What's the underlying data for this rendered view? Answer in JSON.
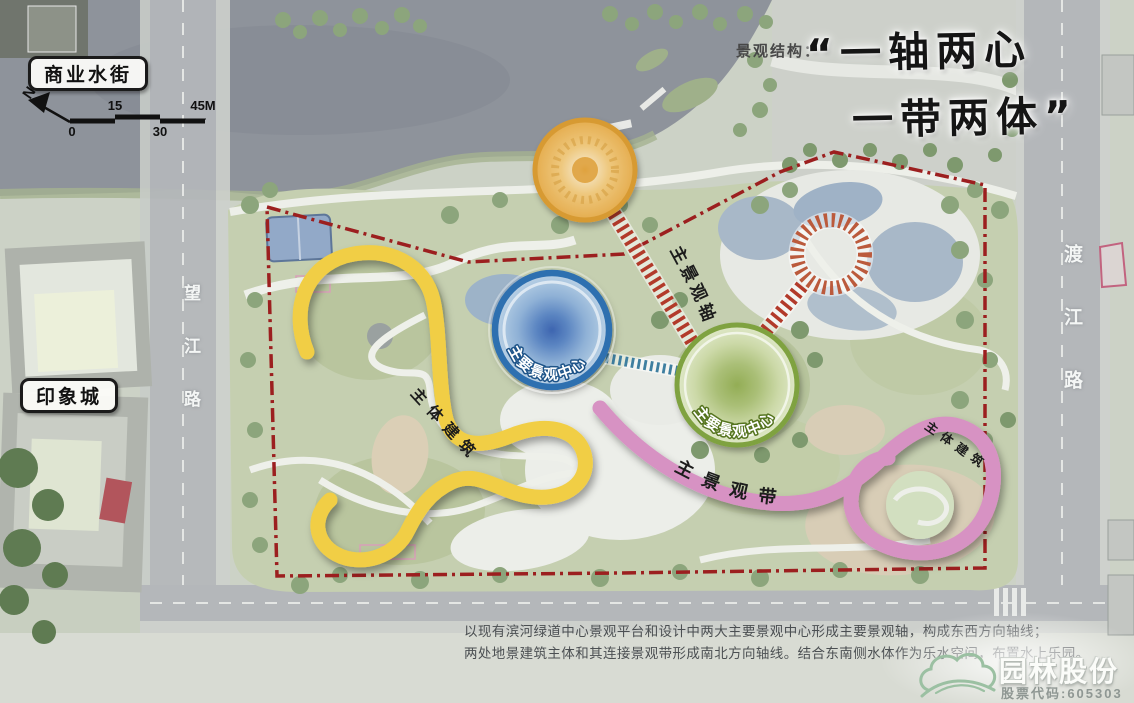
{
  "header": {
    "structure_label": "景观结构：",
    "quote_line1": "“一轴两心",
    "quote_line2": "一带两体”"
  },
  "compass": {
    "north": "N"
  },
  "scalebar": {
    "zero": "0",
    "fifteen": "15",
    "thirty": "30",
    "end": "45M"
  },
  "site_labels": {
    "commercial_street": "商业水街",
    "impression_city": "印象城",
    "wangjiang_road": "望江路",
    "dujiang_road": "渡江路"
  },
  "plan_annotations": {
    "main_axis": "主景观轴",
    "main_center_blue": "主要景观中心",
    "main_center_green": "主要景观中心",
    "main_belt": "主景观带",
    "main_building_left": "主体建筑",
    "main_building_right": "主体建筑"
  },
  "description": {
    "line1": "以现有滨河绿道中心景观平台和设计中两大主要景观中心形成主要景观轴，构成东西方向轴线；",
    "line2": "两处地景建筑主体和其连接景观带形成南北方向轴线。结合东南侧水体作为乐水空间，布置水上乐园。"
  },
  "logo": {
    "company": "园林股份",
    "stock_code": "股票代码:605303"
  },
  "colors": {
    "boundary_red": "#9c1f1f",
    "axis_red": "#b23a2a",
    "axis_blue": "#3f7fa0",
    "sunburst_red": "#bb5a3c",
    "ribbon_yellow": "#f1ce44",
    "ribbon_pink": "#d792c3",
    "node_orange": "#d79a33",
    "node_blue": "#2e6fb0",
    "node_green": "#7fa23f"
  }
}
